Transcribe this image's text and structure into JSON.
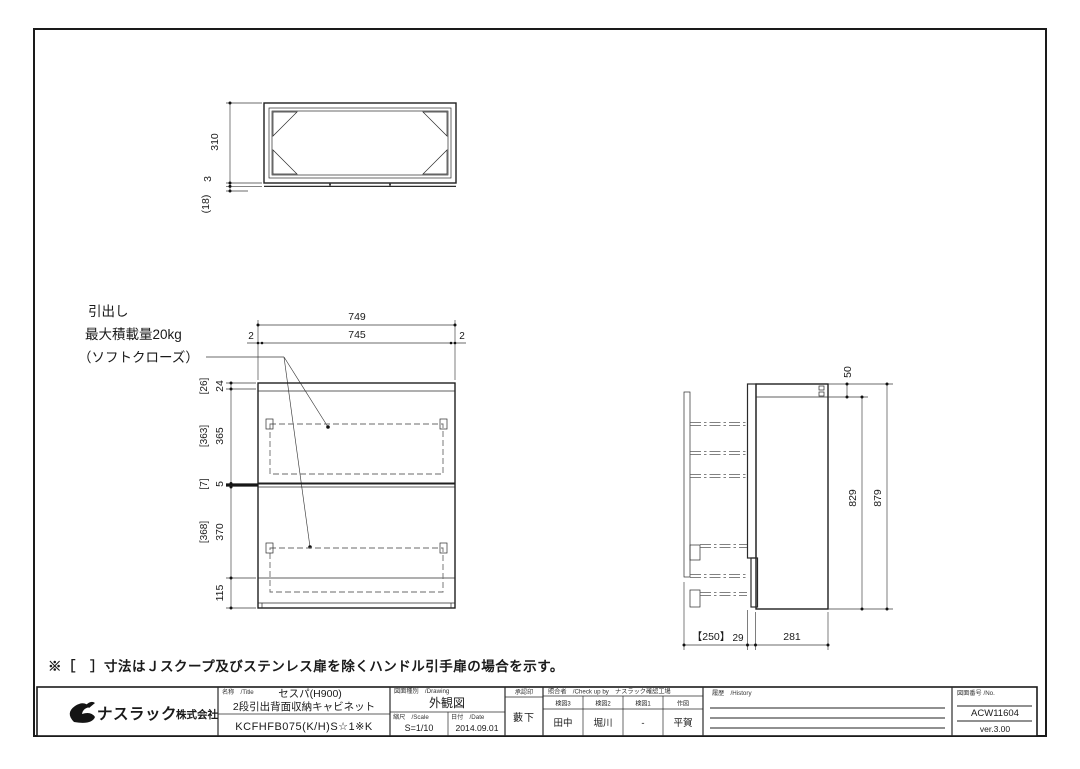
{
  "sheet": {
    "note": "※［　］寸法はＪスクープ及びステンレス扉を除くハンドル引手扉の場合を示す。"
  },
  "top_view": {
    "dims": {
      "depth": "310",
      "back_panel": "3",
      "gap": "(18)"
    }
  },
  "front_view": {
    "label_line1": "引出し",
    "label_line2": "最大積載量20kg",
    "label_line3": "（ソフトクローズ）",
    "dims": {
      "overall_width": "749",
      "inner_width": "745",
      "side_left": "2",
      "side_right": "2",
      "top_rail": "24",
      "top_rail_alt": "[26]",
      "drawer1": "365",
      "drawer1_alt": "[363]",
      "gap": "5",
      "gap_alt": "[7]",
      "drawer2": "370",
      "drawer2_alt": "[368]",
      "bottom": "115"
    }
  },
  "side_view": {
    "dims": {
      "top_box": "50",
      "inner_height": "829",
      "overall_height": "879",
      "pullout": "【250】",
      "door": "29",
      "depth": "281"
    }
  },
  "title_block": {
    "company_main": "ナスラック",
    "company_suffix": "株式会社",
    "title_label": "名称　/Title",
    "product_series": "セスパ(H900)",
    "product_name": "2段引出背面収納キャビネット",
    "product_code": "KCFHFB075(K/H)S☆1※K",
    "drawing_type_label": "図面種別　/Drawing",
    "drawing_type": "外観図",
    "scale_label": "縮尺　/Scale",
    "scale": "S=1/10",
    "date_label": "日付　/Date",
    "date": "2014.09.01",
    "approval_label": "承認印",
    "approval": "藪下",
    "checkers_label": "照合者　/Check up by　ナスラック確認工場",
    "checkers": [
      {
        "role": "検図3",
        "name": "田中"
      },
      {
        "role": "検図2",
        "name": "堀川"
      },
      {
        "role": "検図1",
        "name": "-"
      },
      {
        "role": "作図",
        "name": "平賀"
      }
    ],
    "history_label": "履歴　/History",
    "number_label": "図面番号 /No.",
    "number": "ACW11604",
    "version": "ver.3.00"
  }
}
